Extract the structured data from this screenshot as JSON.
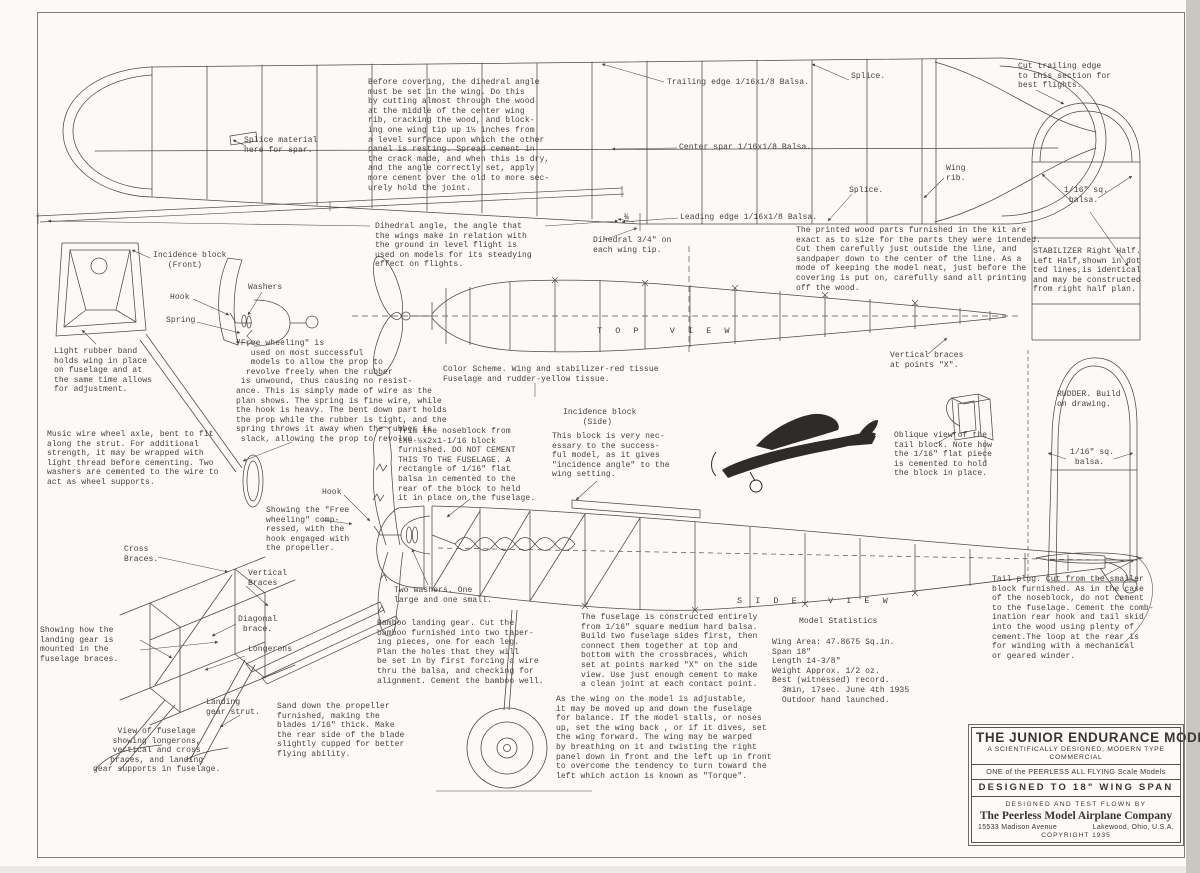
{
  "colors": {
    "paper": "#fbfaf7",
    "ink": "#44423e",
    "line": "#4c4a47"
  },
  "labels": {
    "top_view": "T O P   V I E W",
    "side_view": "S I D E   V I E W"
  },
  "notes": {
    "before_covering": "Before covering, the dihedral angle\nmust be set in the wing. Do this\nby cutting almost through the wood\nat the middle of the center wing\nrib, cracking the wood, and block-\ning one wing tip up 1½ inches from\na level surface upon which the other\npanel is resting. Spread cement in\nthe crack made, and when this is dry,\nand the angle correctly set, apply\nmore cement over the old to more sec-\nurely hold the joint.",
    "splice_material": "Splice material\nhere for spar.",
    "trailing_edge": "Trailing edge 1/16x1/8 Balsa.",
    "splice_top": "Splice.",
    "cut_trailing": "Cut trailing edge\nto this section for\nbest flights.",
    "center_spar": "Center spar 1/16x1/8 Balsa.",
    "wing_rib": "Wing\nrib.",
    "splice_lower": "Splice.",
    "leading_edge": "Leading edge 1/16x1/8 Balsa.",
    "stab_balsa": "1/16\" sq.\n balsa.",
    "stabilizer_note": "STABILIZER Right Half.\nLeft Half,shown in dot\nted lines,is identical\nand may be constructed\nfrom right half plan.",
    "dihedral_note": "Dihedral angle, the angle that\nthe wings make in relation with\nthe ground in level flight is\nused on models for its steadying\neffect on flights.",
    "dihedral_mark": "¾",
    "dihedral_tip": "Dihedral 3/4\" on\neach wing tip.",
    "printed_wood": "The printed wood parts furnished in the kit are\nexact as to size for the parts they were intended.\nCut them carefully just outside the line, and\nsandpaper down to the center of the line. As a\nmode of keeping the model neat, just before the\ncovering is put on, carefully sand all printing\noff the wood.",
    "incidence_front": "Incidence block\n   (Front)",
    "hook_top": "Hook",
    "washers": "Washers",
    "spring": "Spring",
    "rubber_band": "Light rubber band\nholds wing in place\non fuselage and at\nthe same time allows\nfor adjustment.",
    "free_wheeling": "\"Free wheeling\" is\n   used on most successful\n   models to allow the prop to\n  revolve freely when the rubber\n is unwound, thus causing no resist-\nance. This is simply made of wire as the\nplan shows. The spring is fine wire, while\nthe hook is heavy. The bent down part holds\nthe prop while the rubber is tight, and the\nspring throws it away when the rubber is\n slack, allowing the prop to revolve.",
    "color_scheme": "Color Scheme. Wing and stabilizer-red tissue\nFuselage and rudder-yellow tissue.",
    "vertical_braces_x": "Vertical braces\nat points \"X\".",
    "music_wire": "Music wire wheel axle, bent to fit\nalong the strut. For additional\nstrength, it may be wrapped with\nlight thread before cementing. Two\nwashers are cemented to the wire to\nact as wheel supports.",
    "trim_noseblock": "Trim the noseblock from\nthe ½x2x1-1/16 block\nfurnished. DO NOT CEMENT\nTHIS TO THE FUSELAGE. A\nrectangle of 1/16\" flat\nbalsa in cemented to the\nrear of the block to held\nit in place on the fuselage.",
    "incidence_side_title": "Incidence block\n    (Side)",
    "incidence_side_body": "This block is very nec-\nessary to the success-\nful model, as it gives\n\"incidence angle\" to the\nwing setting.",
    "oblique_view": "Oblique view of the\ntail block. Note how\nthe 1/16\" flat piece\nis cemented to hold\nthe block in place.",
    "rudder_note": "RUDDER. Build\non drawing.",
    "rudder_balsa": "1/16\" sq.\n balsa.",
    "hook_bottom": "Hook",
    "freewheel_compressed": "Showing the \"Free\nwheeling\" comp-\nressed, with the\nhook engaged with\nthe propeller.",
    "two_washers": "Two washers. One\nlarge and one small.",
    "cross_braces": "Cross\nBraces.",
    "vertical_braces": "Vertical\nBraces",
    "diagonal_brace": "Diagonal\n brace.",
    "longerons": "Longerons",
    "gear_mounted": "Showing how the\nlanding gear is\nmounted in the\nfuselage braces.",
    "gear_strut": "Landing\ngear strut.",
    "fuselage_view": "View of fuselage\nshowing longerons,\nvertical and cross\nbraces, and landing\ngear supports in fuselage.",
    "bamboo": "Bamboo landing gear. Cut the\nbamboo furnished into two taper-\ning pieces, one for each leg.\nPlan the holes that they will\nbe set in by first forcing a wire\nthru the balsa, and checking for\nalignment. Cement the bamboo well.",
    "sand_prop": "Sand down the propeller\nfurnished, making the\nblades 1/16\" thick. Make\nthe rear side of the blade\nslightly cupped for better\nflying ability.",
    "fuselage_construction": "The fuselage is constructed entirely\nfrom 1/16\" square medium hard balsa.\nBuild two fuselage sides first, then\nconnect them together at top and\nbottom with the crossbraces, which\nset at points marked \"X\" on the side\nview. Use just enough cement to make\na clean joint at each contact point.",
    "wing_adjustable": "As the wing on the model is adjustable,\nit may be moved up and down the fuselage\nfor balance. If the model stalls, or noses\nup, set the wing back , or if it dives, set\nthe wing forward. The wing may be warped\nby breathing on it and twisting the right\npanel down in front and the left up in front\nto overcome the tendency to turn toward the\nleft which action is known as \"Torque\".",
    "tail_plug": "Tail plug. Cut from the smaller\nblock furnished. As in the case\nof the noseblock, do not cement\nto the fuselage. Cement the comb-\nination rear hook and tail skid\ninto the wood using plenty of\ncement.The loop at the rear is\nfor winding with a mechanical\nor geared winder."
  },
  "stats": {
    "title": "Model Statistics",
    "body": "Wing Area: 47.8675 Sq.in.\nSpan 18\"\nLength 14-3/8\"\nWeight Approx. 1/2 oz.\nBest (witnessed) record.\n  3min, 17sec. June 4th 1935\n  Outdoor hand launched."
  },
  "title_block": {
    "model_name": "THE JUNIOR ENDURANCE MODEL",
    "subtitle1": "A SCIENTIFICALLY DESIGNED, MODERN TYPE",
    "subtitle2": "COMMERCIAL",
    "series": "ONE of the PEERLESS ALL FLYING Scale Models",
    "designed_to": "DESIGNED TO 18\" WING SPAN",
    "flown_by": "DESIGNED AND TEST FLOWN BY",
    "company": "The Peerless Model Airplane Company",
    "address_left": "15533 Madison Avenue",
    "address_right": "Lakewood, Ohio, U.S.A.",
    "copyright": "COPYRIGHT 1935"
  }
}
